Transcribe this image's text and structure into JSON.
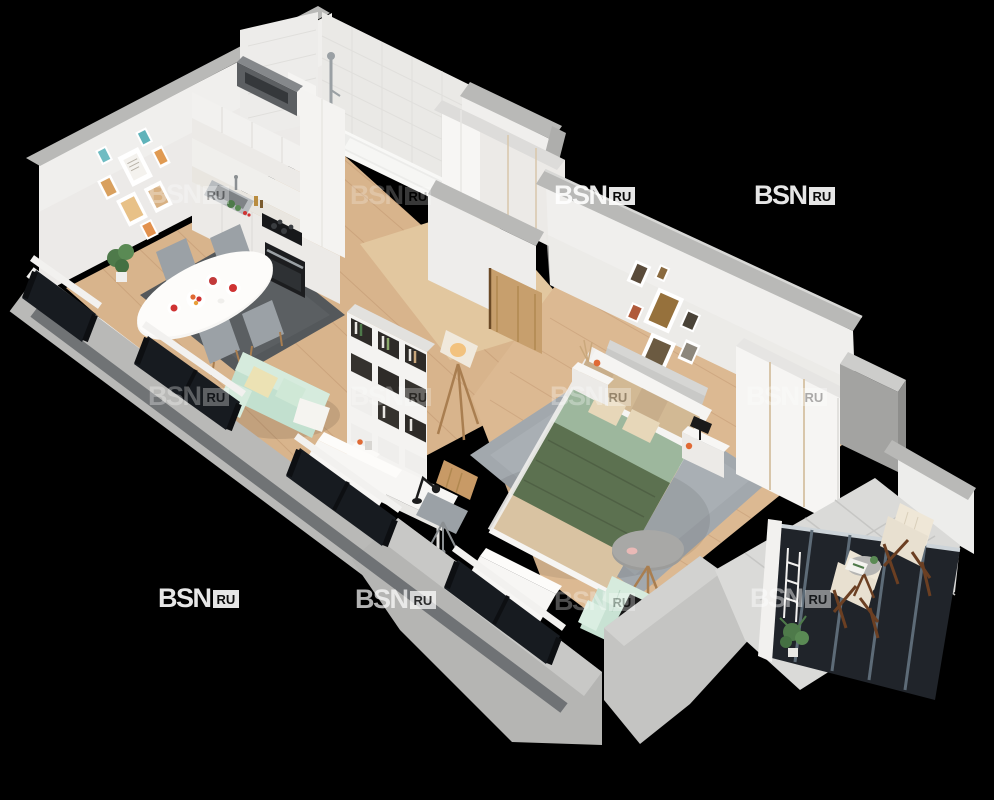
{
  "image": {
    "title": "3D isometric apartment floor plan render (studio flat with balcony)",
    "width": 994,
    "height": 800
  },
  "watermark": {
    "brand": "BSN",
    "suffix": "RU",
    "positions": [
      {
        "x": 148,
        "y": 181,
        "opacity": 0.3
      },
      {
        "x": 350,
        "y": 182,
        "opacity": 0.22
      },
      {
        "x": 554,
        "y": 182,
        "opacity": 0.9
      },
      {
        "x": 754,
        "y": 182,
        "opacity": 0.9
      },
      {
        "x": 148,
        "y": 383,
        "opacity": 0.3
      },
      {
        "x": 350,
        "y": 383,
        "opacity": 0.25
      },
      {
        "x": 550,
        "y": 383,
        "opacity": 0.3
      },
      {
        "x": 746,
        "y": 383,
        "opacity": 0.32
      },
      {
        "x": 158,
        "y": 585,
        "opacity": 0.9
      },
      {
        "x": 355,
        "y": 586,
        "opacity": 0.7
      },
      {
        "x": 554,
        "y": 588,
        "opacity": 0.3
      },
      {
        "x": 750,
        "y": 585,
        "opacity": 0.45
      }
    ]
  },
  "palette": {
    "bg": "#000000",
    "wallTopLight": "#cdcdcb",
    "wallTop": "#b9b9b7",
    "wallSide": "#a3a3a1",
    "wallFace": "#f0efed",
    "wallFaceShade": "#e3e2df",
    "tileWall": "#edecea",
    "tileLine": "#dfdedb",
    "floorWood": "#d8b48c",
    "plank": "#c29872",
    "floorHall": "#e2c79f",
    "tileFloor": "#dadad8",
    "tileFloorLine": "#c6c6c4",
    "glass": "#171b20",
    "frameBlack": "#0d0f12",
    "steelBlue": "#5d6b77",
    "railLight": "#cdd4d9",
    "white": "#f7f6f4",
    "counter": "#e9e6e0",
    "appliance": "#17181a",
    "steel": "#b8bcbf",
    "rugDark": "#54585b",
    "rugLight": "#a2a8ad",
    "sofaMint": "#c2e0cf",
    "mintLight": "#d6ebdd",
    "pillowCream": "#ece2b4",
    "bedGreen": "#5c7150",
    "bedGreenDark": "#4c5d42",
    "bedSage": "#9db79d",
    "bedBeige": "#d9c3a2",
    "pillowTan": "#c8ae8b",
    "pillowBeige": "#e7d7b9",
    "headboard": "#c9c9c7",
    "oak": "#c79f6d",
    "woodLeg": "#a97e50",
    "darkWood": "#6b3f22",
    "chairGray": "#9ba1a6",
    "lampWarm": "#f2c27e",
    "orange": "#e06a35",
    "red": "#cf3333",
    "plantGreen": "#4e7a4a",
    "tableGray": "#9c9c9a",
    "sillDark": "#63666a",
    "wmWhite": "#ffffff"
  },
  "scene": {
    "style": "isometric cutaway 3D render, white interior walls, gray sliced outer walls, black background",
    "rooms": [
      {
        "name": "kitchen-living-room",
        "furniture": [
          "white-kitchen-cabinets",
          "marble-countertop",
          "steel-sink",
          "black-cooktop",
          "black-oven",
          "range-hood",
          "gallery-wall-beach-prints",
          "potted-plant",
          "oval-dining-table",
          "red-plates-and-fruit-bowl",
          "gray-dining-chairs",
          "charcoal-rug",
          "mint-sofa-with-pillows",
          "cube-shelving-unit-with-books",
          "tripod-floor-lamp",
          "white-desk",
          "black-desk-lamp",
          "wood-and-gray-desk-chair",
          "white-drawer-cabinet"
        ]
      },
      {
        "name": "bathroom",
        "furniture": [
          "white-tile-walls",
          "bathtub",
          "shower-column"
        ]
      },
      {
        "name": "hallway",
        "furniture": [
          "tall-white-wardrobe",
          "entry-door-opening",
          "oak-interior-door",
          "wood-floor"
        ]
      },
      {
        "name": "bedroom",
        "furniture": [
          "gallery-wall-dark-prints",
          "gray-upholstered-headboard",
          "double-bed-green-and-beige-bedding",
          "tan-pillows",
          "white-nightstand-left",
          "white-nightstand-right",
          "black-table-lamp",
          "orange-vases",
          "white-wardrobe-wood-trim",
          "gray-fluffy-rug",
          "round-gray-side-table",
          "mint-tufted-armchair",
          "black-cushion"
        ]
      },
      {
        "name": "balcony",
        "furniture": [
          "dark-glazed-panels",
          "tile-floor",
          "wooden-folding-chairs-with-cushions",
          "small-round-table-with-magazine",
          "potted-plants"
        ]
      }
    ],
    "exterior": [
      "gray-cutaway-front-wall",
      "dark-windows-with-black-frames",
      "white-window-sill-boxes"
    ]
  }
}
